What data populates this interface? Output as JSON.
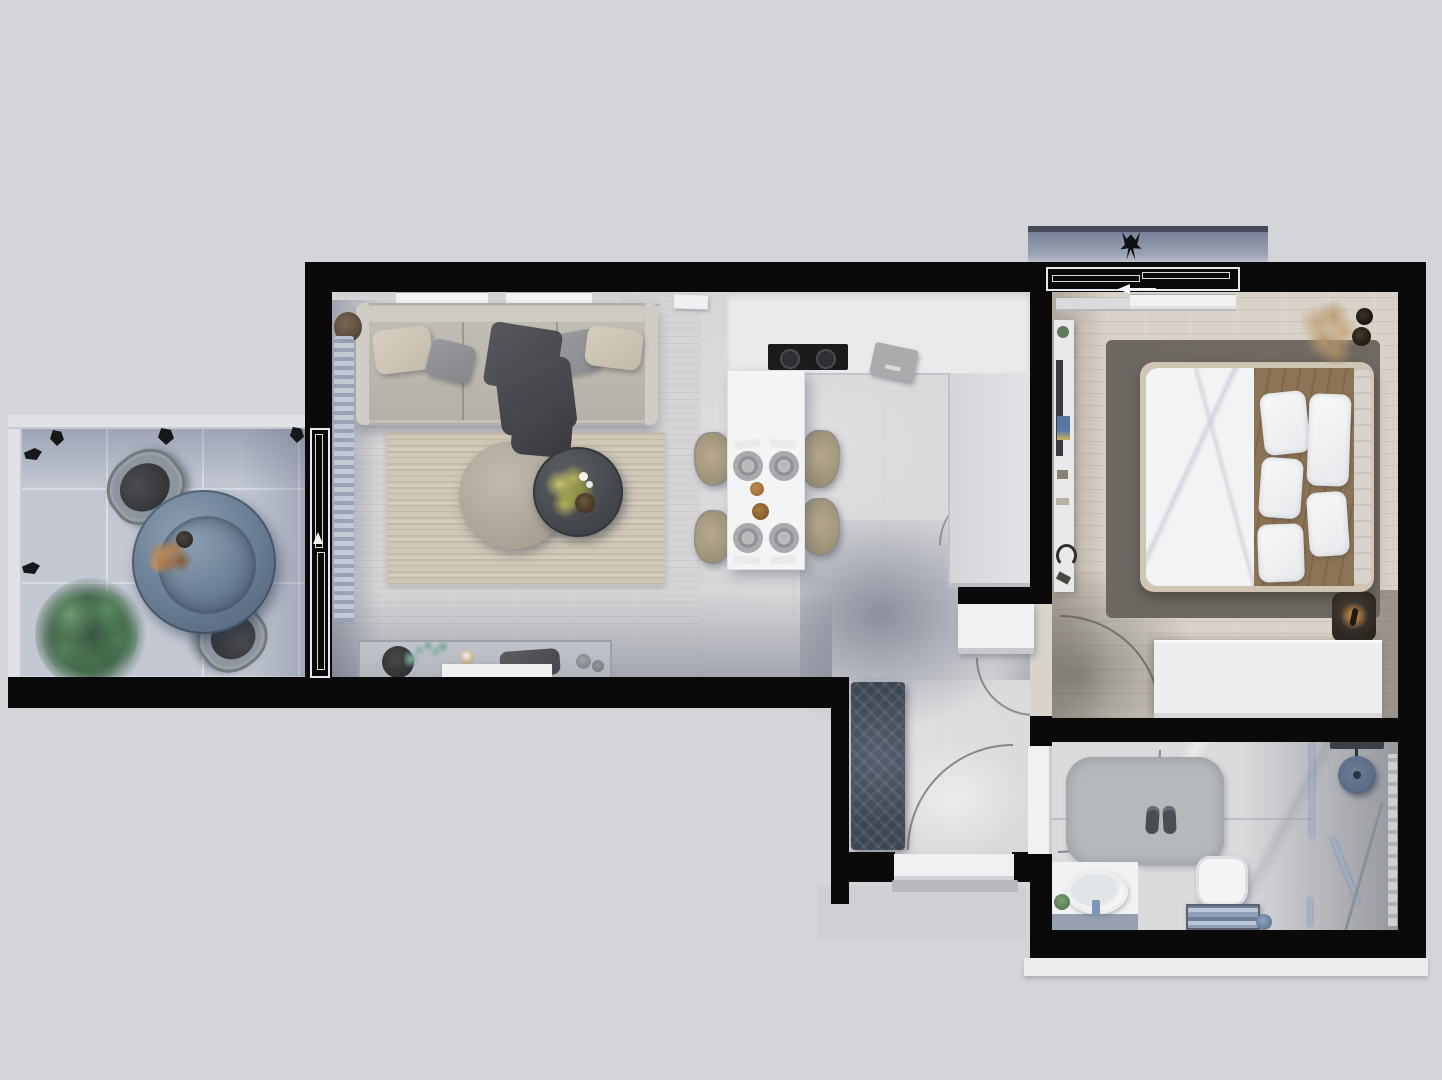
{
  "meta": {
    "type": "3d-floor-plan-render",
    "view": "top-down",
    "width_px": 1442,
    "height_px": 1080,
    "visible_text": ""
  },
  "palette": {
    "background": "#d4d5d8",
    "wall": "#0a0a0b",
    "balcony_floor": "#c3c8d3",
    "living_floor": "#d5d5d7",
    "wood_floor": "#d8d2c8",
    "bath_floor": "#dadbdd",
    "counter": "#e9eaec",
    "cabinet": "#dcdde0",
    "table_white": "#f3f4f6",
    "chair_tan": "#ab9e84",
    "sofa": "#c4c0b8",
    "rug_living": "#cfc8b7",
    "rug_bedroom": "#6e6862",
    "rug_hall": "#3e4553",
    "glass_blue": "#64788e",
    "plant_green": "#4c7453",
    "plant_yellow": "#bcb95c",
    "bed_white": "#f2f3f5",
    "blanket_brown": "#8d7456",
    "lamp_glow": "#e89a43",
    "mat_grey": "#b6b9bb",
    "fixture_blue": "#5d6d88",
    "door_white": "#f1f1f3",
    "step_grey": "#b8b9bd"
  },
  "rooms": [
    {
      "name": "terrace",
      "items": [
        "round-glass-table",
        "wicker-chair",
        "wicker-chair",
        "flower-centerpiece",
        "potted-plant",
        "wall-sconce",
        "wall-sconce",
        "wall-sconce",
        "wall-sconce",
        "wall-sconce",
        "sliding-door"
      ]
    },
    {
      "name": "living-room",
      "items": [
        "three-seat-sofa",
        "throw-pillows",
        "dark-throw-blanket",
        "striped-rug",
        "round-pouf",
        "round-coffee-table",
        "yellow-plant",
        "candles",
        "decor-bowl",
        "media-sideboard",
        "curtain",
        "window-sills",
        "side-table-vase"
      ]
    },
    {
      "name": "kitchen-dining",
      "items": [
        "counter-with-cooktop",
        "cutting-board",
        "tall-cabinet-block",
        "dining-table",
        "dining-chair",
        "dining-chair",
        "dining-chair",
        "dining-chair",
        "place-setting",
        "place-setting",
        "place-setting",
        "place-setting",
        "bread-decor"
      ]
    },
    {
      "name": "hallway",
      "items": [
        "herringbone-runner-rug",
        "entry-door",
        "entry-step",
        "door-swing-arcs",
        "shoe-cabinet"
      ]
    },
    {
      "name": "bedroom",
      "items": [
        "double-bed",
        "white-duvet",
        "brown-blanket",
        "pillows",
        "headboard",
        "area-rug",
        "wardrobe",
        "nightstand",
        "glowing-lamp",
        "wall-console",
        "pampas-plant",
        "window-sills",
        "sliding-balcony-door"
      ]
    },
    {
      "name": "bedroom-balcony",
      "items": [
        "railing",
        "bird-silhouette"
      ]
    },
    {
      "name": "bathroom",
      "items": [
        "bath-mat",
        "slippers",
        "vanity-sink",
        "faucet",
        "small-plant",
        "toilet",
        "towel-shelf",
        "shower-glass-screen",
        "rain-shower-head",
        "shower-controls",
        "towel-radiator",
        "squeegee"
      ]
    }
  ]
}
